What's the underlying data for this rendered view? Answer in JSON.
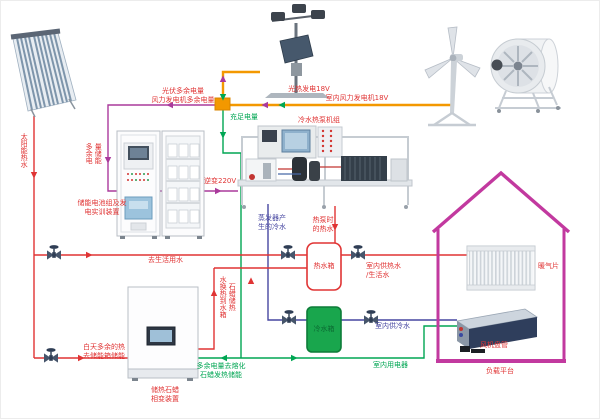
{
  "diagram_title": "太阳能/风能综合能源实训系统示意图",
  "colors": {
    "electric_excess_magenta": "#aa3a9c",
    "electric_sufficient_green": "#00a653",
    "electric_bus_orange": "#f39800",
    "hot_water_red": "#e03434",
    "cold_water_blue": "#4747a1",
    "house_outline": "#c2399f",
    "cold_tank_fill": "#19a64d"
  },
  "labels": {
    "pv_wind_excess": "光伏多余电量\n风力发电机多余电量",
    "sufficient_power": "充足电量",
    "solar_thermal_gen": "光热发电18V",
    "indoor_wind_gen": "室内风力发电机18V",
    "excess_storage_vertical": "多余电\n量储能",
    "battery_cabinet": "储能电池组及发\n电实训装置",
    "inverter_220v": "逆变220V",
    "heat_pump_unit": "冷水热泵机组",
    "solar_hot_water": "太阳能热水",
    "to_domestic_water": "去生活用水",
    "day_excess_heat": "白天多余的热\n去储能箱储能",
    "paraffin_device": "储热石蜡\n相变装置",
    "paraffin_to_tank": "石蜡储热\n水换热到水箱",
    "excess_melt_paraffin": "多余电量去熔化\n石蜡发热储能",
    "evaporator_cold_water": "蒸发器产\n生的冷水",
    "heat_pump_hot_water": "热泵时\n的热水",
    "hot_water_tank": "热水箱",
    "cold_water_tank": "冷水箱",
    "indoor_hot_water": "室内供热水\n/生活水",
    "indoor_cold_water": "室内供冷水",
    "indoor_appliances": "室内用电器",
    "radiator": "暖气片",
    "fan_coil": "风机盘管",
    "load_platform": "负载平台"
  }
}
